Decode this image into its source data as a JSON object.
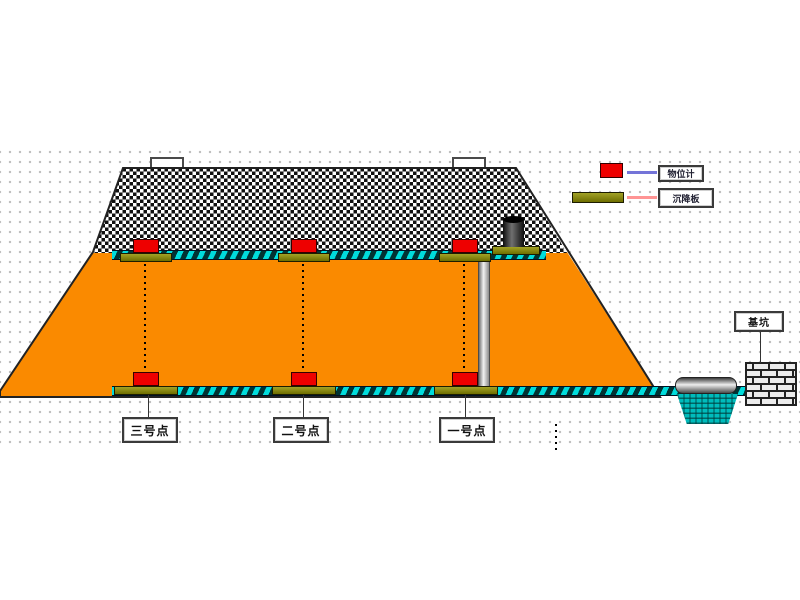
{
  "legend": {
    "items": [
      {
        "label": "物位计",
        "swatch": "red-level-gauge",
        "swatch_color": "#ee0000",
        "line_color": "#7474d8"
      },
      {
        "label": "沉降板",
        "swatch": "olive-settlement-plate",
        "swatch_color": "#7e7e00",
        "line_color": "#ff9494"
      }
    ]
  },
  "points": [
    {
      "label": "三号点"
    },
    {
      "label": "二号点"
    },
    {
      "label": "一号点"
    }
  ],
  "structures": {
    "pit_label": "基坑"
  },
  "colors": {
    "embankment_fill": "#fa8a00",
    "gravel_stipple": "#111111",
    "band_teal": "#00dcdc",
    "sensor_red": "#ee0000",
    "plate_olive": "#7e7e00",
    "pool_teal": "#00bcbc"
  }
}
